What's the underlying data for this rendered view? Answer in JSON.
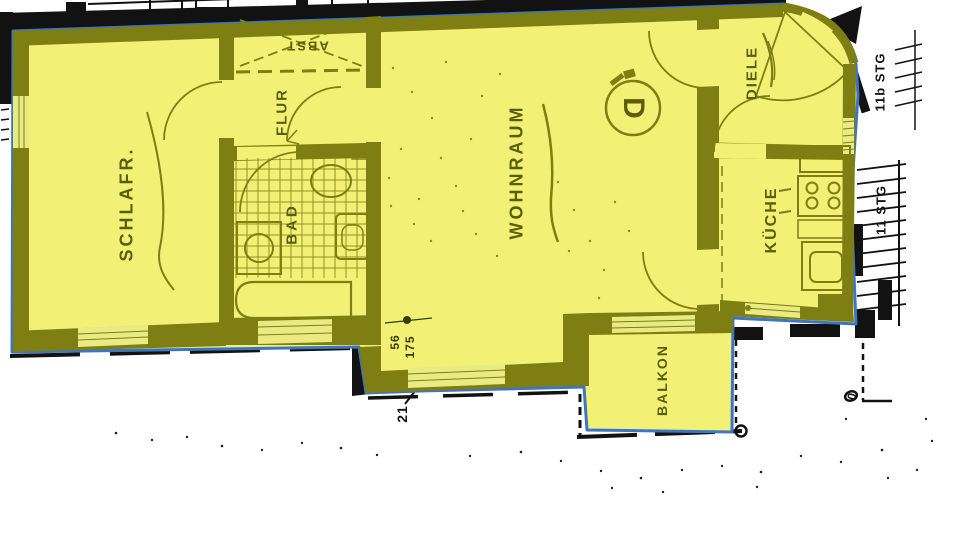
{
  "plan": {
    "unit_label": "D",
    "rooms": [
      {
        "id": "schlafzimmer",
        "label": "SCHLAFR."
      },
      {
        "id": "flur",
        "label": "FLUR"
      },
      {
        "id": "abstellraum",
        "label": "ABST"
      },
      {
        "id": "bad",
        "label": "BAD"
      },
      {
        "id": "wohnraum",
        "label": "WOHNRAUM"
      },
      {
        "id": "diele",
        "label": "DIELE"
      },
      {
        "id": "kueche",
        "label": "KÜCHE"
      },
      {
        "id": "balkon",
        "label": "BALKON"
      }
    ],
    "stair_labels": {
      "upper": "11b STG",
      "lower": "11 STG"
    },
    "dimensions": {
      "dim_56": "56",
      "dim_175": "175",
      "dim_21": "21",
      "dim_0": "0"
    },
    "colors": {
      "highlight": "#f2f175",
      "window": "#eaea82",
      "wall": "#7e7e13",
      "label": "#5c5c0a",
      "outline": "#3b76c5",
      "ink": "#121212",
      "paper": "#ffffff"
    }
  }
}
